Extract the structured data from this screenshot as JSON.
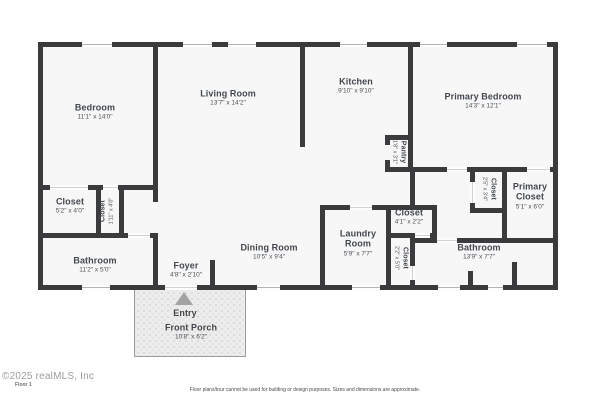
{
  "floorplan": {
    "rooms": [
      {
        "name": "Bedroom",
        "dims": "11'1\" x 14'0\""
      },
      {
        "name": "Living Room",
        "dims": "13'7\" x 14'2\""
      },
      {
        "name": "Kitchen",
        "dims": "9'10\" x 9'10\""
      },
      {
        "name": "Primary Bedroom",
        "dims": "14'3\" x 12'1\""
      },
      {
        "name": "Pantry",
        "dims": "1'8\" x 3'1\""
      },
      {
        "name": "Closet",
        "dims": "5'2\" x 4'0\""
      },
      {
        "name": "Closet",
        "dims": "1'11\" x 4'0\""
      },
      {
        "name": "Bathroom",
        "dims": "11'2\" x 5'0\""
      },
      {
        "name": "Foyer",
        "dims": "4'8\" x 2'10\""
      },
      {
        "name": "Dining Room",
        "dims": "10'5\" x 9'4\""
      },
      {
        "name": "Laundry Room",
        "dims": "5'9\" x 7'7\""
      },
      {
        "name": "Closet",
        "dims": "4'1\" x 2'2\""
      },
      {
        "name": "Closet",
        "dims": "2'2\" x 5'0\""
      },
      {
        "name": "Closet",
        "dims": "2'5\" x 3'4\""
      },
      {
        "name": "Primary Closet",
        "dims": "5'1\" x 6'0\""
      },
      {
        "name": "Bathroom",
        "dims": "13'9\" x 7'7\""
      },
      {
        "name": "Entry",
        "dims": ""
      },
      {
        "name": "Front Porch",
        "dims": "10'8\" x 6'2\""
      }
    ],
    "footer": {
      "watermark": "©2025 realMLS, Inc",
      "floor_label": "Floor 1",
      "disclaimer": "Floor plans/tour cannot be used for building or design purposes. Sizes and dimensions are approximate."
    },
    "colors": {
      "wall": "#3b3b3d",
      "floor": "#f7f7f8",
      "porch": "#ededed"
    }
  }
}
